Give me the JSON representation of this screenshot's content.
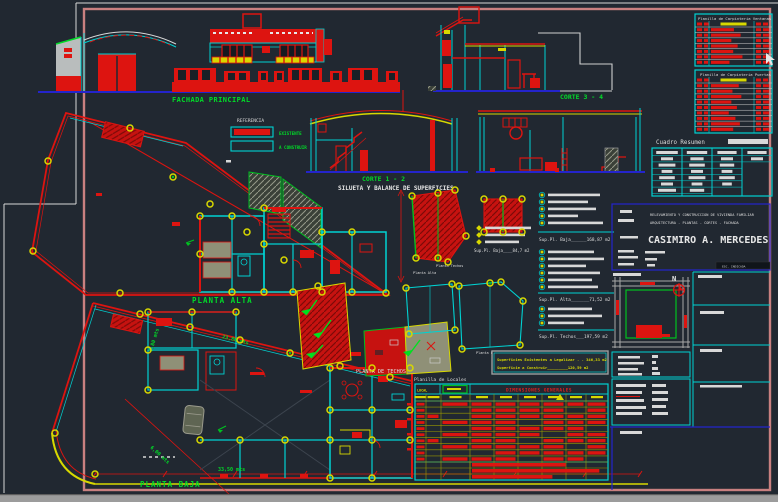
{
  "drawing": {
    "labels": {
      "fachada_principal": "FACHADA PRINCIPAL",
      "corte_12": "CORTE 1 - 2",
      "corte_34": "CORTE 3 - 4",
      "silueta_title": "SILUETA Y BALANCE DE SUPERFICIES",
      "planta_alta": "PLANTA ALTA",
      "planta_baja": "PLANTA BAJA",
      "planta_techos": "PLANTA DE TECHOS",
      "north": "N"
    },
    "referencia": {
      "title": "REFERENCIA",
      "existente": "EXISTENTE",
      "a_construir": "A CONSTRUIR"
    },
    "tables": {
      "ventanas": {
        "title": "Planilla de Carpinteria Ventanas",
        "rows": [
          0.62,
          0.8,
          0.55,
          0.72,
          0.6,
          0.85,
          0.5
        ]
      },
      "puertas": {
        "title": "Planilla de Carpinteria Puertas",
        "rows": [
          0.75,
          0.58,
          0.82,
          0.55,
          0.7,
          0.48,
          0.66,
          0.78,
          0.6
        ]
      },
      "cuadro_resumen": {
        "title": "Cuadro Resumen",
        "columns": [
          [
            0.9,
            0.5,
            0.7,
            0.45,
            0.65,
            0.5,
            0.75
          ],
          [
            0.85,
            0.55,
            0.65,
            0.5,
            0.7,
            0.45,
            0.6
          ],
          [
            0.8,
            0.5,
            0.6,
            0.45,
            0.65,
            0.4,
            0
          ],
          [
            0.8,
            0.5,
            0,
            0,
            0,
            0,
            0
          ]
        ]
      },
      "locales": {
        "title": "Planilla de Locales",
        "col1_header": "LOCAL",
        "header": "DIMENSIONES GENERALES",
        "rows": [
          "101111111",
          "100111101",
          "110111111",
          "101110111",
          "100111110",
          "101111011",
          "110110111",
          "101111101",
          "100011111",
          "101110110"
        ],
        "bottom_bars": [
          0.7,
          0.95,
          0.6
        ]
      }
    },
    "superficies": {
      "sup_baja_small": "Sup.Pl. Baja____84,7 m2",
      "sup_baja": "Sup.Pl. Baja______168,87 m2",
      "sup_alta": "Sup.Pl. Alta_______71,52 m2",
      "sup_techos": "Sup.Pl. Techos___197,59 m2",
      "resumen1": "Superficies Existentes a Legalizar . . 346,33 m2",
      "resumen2": "Superficie a Construir_________120,59 m2",
      "list_g1": [
        52,
        40,
        48,
        30,
        55
      ],
      "list_g2": [
        46,
        56,
        38,
        52,
        44,
        50
      ],
      "list_g3": [
        44,
        54,
        36
      ],
      "list_g4": [
        46,
        40,
        34
      ]
    },
    "silhouettes": {
      "techos": "Planta Techos",
      "alta": "Planta Alta",
      "baja": "Planta Baja"
    },
    "dimensions": {
      "d1": "7,80 mts",
      "d2": "6,00 mts",
      "d3": "33,50 mts",
      "d4": "23,80 mts"
    },
    "title_block": {
      "line1": "RELEVAMIENTO Y CONSTRUCCION DE VIVIENDA FAMILIAR",
      "line2": "ARQUITECTURA - PLANTAS - CORTES - FACHADA",
      "owner": "CASIMIRO A. MERCEDES",
      "esc": "ESC. INDICADA"
    },
    "colors": {
      "background": "#212831",
      "red": "#dd1410",
      "cyan": "#00d2d2",
      "green": "#00dc28",
      "yellow": "#d8d800",
      "blue": "#2424cc",
      "white": "#dedede",
      "salmon": "#c98080",
      "gray": "#b9bdbd",
      "olive": "#8f9077"
    }
  }
}
